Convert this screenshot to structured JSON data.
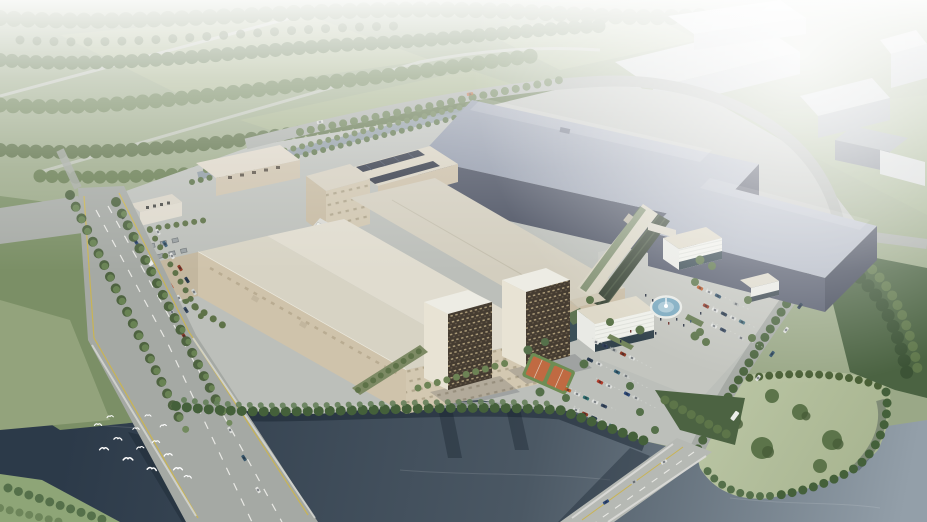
{
  "scene": {
    "title": "Aerial architectural rendering of a riverside industrial campus",
    "type": "photorealistic site render, bird's-eye perspective, hazy daylight",
    "visible_text": "none",
    "regions": {
      "top": "hazy forest, fields and faded city blocks",
      "center_left": "cream factory halls with rooftop cooling equipment and solar panels",
      "center": "two large blue-grey logistics warehouses",
      "center_right": "office slab with green facade, white louvered buildings, circular fountain plaza, parking lots, basketball court",
      "south": "two bronze dormitory towers on the riverfront",
      "bottom": "dark river with bird flock, two road bridges, wooded park peninsula"
    },
    "palette": {
      "haze": "#ffffff",
      "field_green": "#9aa887",
      "field_light": "#a9b58f",
      "forest_green": "#62774f",
      "tree_dark": "#47603c",
      "campus_ground": "#bcbfba",
      "plaza_ground": "#c4c7c1",
      "asphalt": "#a5a9a4",
      "lane_yellow": "#c9b454",
      "lane_white": "#e8e8e4",
      "river_dark": "#2c3a49",
      "river_mid": "#4b5864",
      "river_light": "#939fa9",
      "reflection": "#182330",
      "factory_wall": "#cfc3ab",
      "factory_wall_shaded": "#c3b79f",
      "factory_roof": "#dcd8ca",
      "factory_roof_light": "#e0dccf",
      "warehouse_wall": "#4f5565",
      "warehouse_wall_dark": "#3f4455",
      "warehouse_roof_light": "#b2b8c4",
      "warehouse_roof_dark": "#8d95a6",
      "dorm_facade": "#453c31",
      "dorm_end_wall": "#e8e3d4",
      "office_green_facade": "#3f4a3c",
      "louver_white": "#eff0ea",
      "glass_dark": "#33434c",
      "fountain_blue": "#7ba9bf",
      "fountain_inner": "#a9c8d6",
      "court_orange": "#c06a42",
      "court_green": "#6e8d54",
      "solar_panel": "#343a48",
      "park_lawn": "#b5c1a0",
      "bird_white": "#ffffff"
    },
    "counts": {
      "bridges": 2,
      "dormitory_towers": 2,
      "warehouses": 2,
      "fountains": 1
    }
  }
}
